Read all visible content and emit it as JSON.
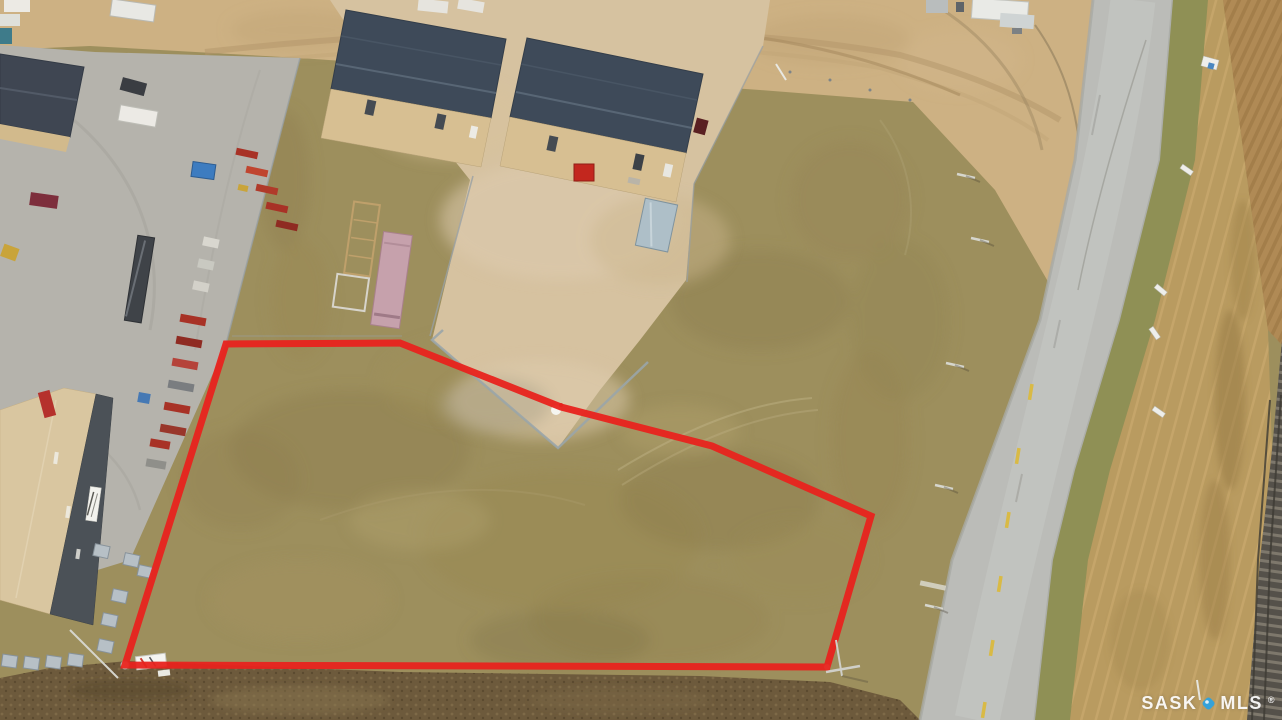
{
  "photo": {
    "description": "Aerial drone photo of a vacant commercial lot outlined in red, beside industrial warehouse buildings, an equipment yard, a highway and a railway line"
  },
  "boundary": {
    "points": "226,344 400,343 561,407 712,446 871,516 827,667 125,665",
    "color": "#e8231d",
    "stroke_width": "7"
  },
  "watermark": {
    "brand_left": "SASK",
    "brand_right": "MLS",
    "registered_mark": "®",
    "pin_color": "#35a2d8",
    "text_color": "#ffffff"
  }
}
